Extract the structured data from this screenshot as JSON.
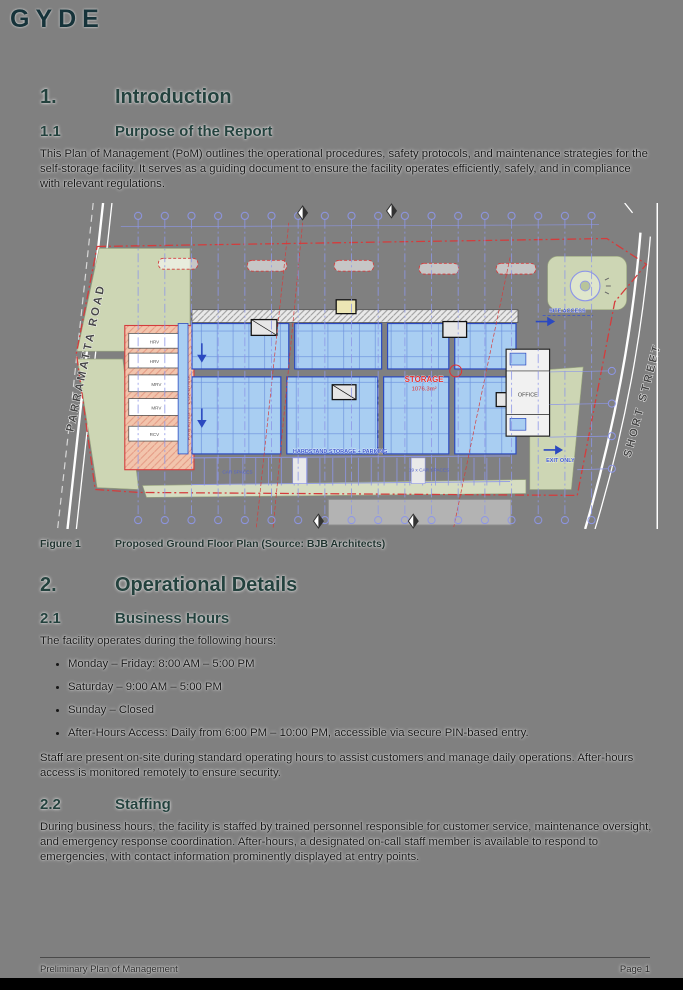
{
  "logo": "GYDE",
  "intro": {
    "number": "1.",
    "title": "Introduction"
  },
  "purpose": {
    "number": "1.1",
    "title": "Purpose of the Report",
    "body": "This Plan of Management (PoM) outlines the operational procedures, safety protocols, and maintenance strategies for the self-storage facility. It serves as a guiding document to ensure the facility operates efficiently, safely, and in compliance with relevant regulations."
  },
  "figure": {
    "label": "Figure 1",
    "caption": "Proposed Ground Floor Plan (Source: BJB Architects)"
  },
  "plan": {
    "street_left": "PARRAMATTA ROAD",
    "street_right": "SHORT STREET",
    "storage_label": "STORAGE",
    "storage_area": "1076.3m²",
    "office_label": "OFFICE",
    "site_access": "SITE ACCESS",
    "exit_only": "EXIT ONLY",
    "hardstand": "HARDSTAND STORAGE + PARKING",
    "car_spaces_left": "CAR SPACES",
    "car_spaces_right": "19 x CAR SPACES",
    "parking_loading": "PARKING / LOADING",
    "vehicle_bays": [
      "HRV",
      "HRV",
      "MRV",
      "MRV",
      "RCV"
    ]
  },
  "operational": {
    "number": "2.",
    "title": "Operational Details"
  },
  "business": {
    "number": "2.1",
    "title": "Business Hours",
    "lead": "The facility operates during the following hours:",
    "bullets": [
      "Monday – Friday: 8:00 AM – 5:00 PM",
      "Saturday – 9:00 AM – 5:00 PM",
      "Sunday – Closed",
      "After-Hours Access: Daily from 6:00 PM – 10:00 PM, accessible via secure PIN-based entry."
    ],
    "note": "Staff are present on-site during standard operating hours to assist customers and manage daily operations. After-hours access is monitored remotely to ensure security."
  },
  "staffing": {
    "number": "2.2",
    "title": "Staffing",
    "body": "During business hours, the facility is staffed by trained personnel responsible for customer service, maintenance oversight, and emergency response coordination. After-hours, a designated on-call staff member is available to respond to emergencies, with contact information prominently displayed at entry points."
  },
  "footer": {
    "left": "Preliminary Plan of Management",
    "right": "Page 1"
  },
  "colors": {
    "page_bg": "#808080",
    "heading": "#24423e",
    "logo": "#16333a",
    "plan_blue_fill": "#a9cef2",
    "plan_blue_line": "#2b49c0",
    "plan_grid": "#8d96e8",
    "plan_red": "#d43c3c",
    "plan_green": "#cdd6b4",
    "plan_salmon": "#f2c4ac"
  }
}
